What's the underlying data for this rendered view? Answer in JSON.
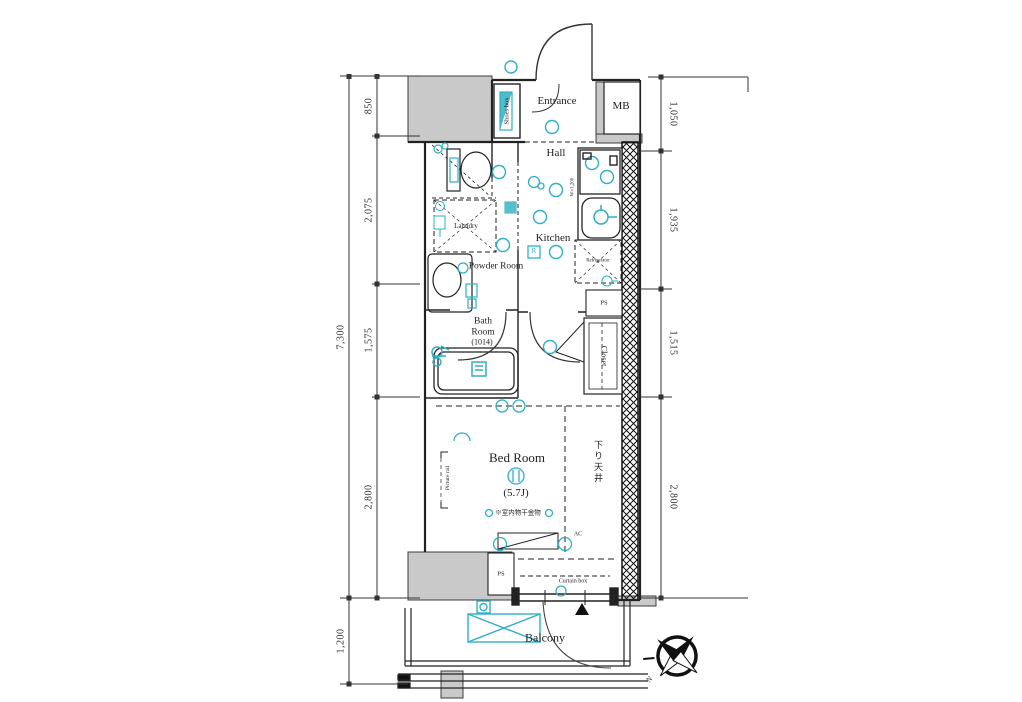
{
  "rooms": {
    "entrance": "Entrance",
    "mb": "MB",
    "hall": "Hall",
    "shoes_box": "Shoes box",
    "kitchen": "Kitchen",
    "kitchen_width": "W=1,200",
    "laundry": "Laundry",
    "powder_room": "Powder Room",
    "refrigerator": "Refrigerator",
    "bath_room": "Bath Room",
    "bath_size": "(1014)",
    "ps_upper": "PS",
    "closet": "Closet",
    "bed_room": "Bed Room",
    "bed_size": "(5.7J)",
    "bed_note": "※室内物干金物",
    "dropped_ceiling": "下り天井",
    "picture_rail": "Picture rail",
    "ac": "AC",
    "curtain_box": "Curtain box",
    "ps_lower": "PS",
    "balcony": "Balcony",
    "remote_box": "R",
    "compass_north": "N"
  },
  "dimensions": {
    "left": {
      "total": "7,300",
      "segments": [
        "850",
        "2,075",
        "1,575",
        "2,800"
      ],
      "balcony_depth": "1,200"
    },
    "right": {
      "segments": [
        "1,050",
        "1,935",
        "1,515",
        "2,800"
      ]
    }
  },
  "icons": {
    "compass": "compass-rose",
    "toilet": "toilet",
    "bathtub": "bathtub",
    "sink": "kitchen-sink",
    "stove": "gas-stove",
    "washbasin": "washbasin",
    "washing_machine_pan": "washer-cross-box",
    "downlight": "ceiling-light-circle",
    "door_swing": "door-arc",
    "escape_hatch": "black-triangle-marker"
  },
  "colors": {
    "accent": "#2fafc4",
    "wall_fill": "#c9c9c9",
    "line": "#222222",
    "hatch": "#111111"
  }
}
